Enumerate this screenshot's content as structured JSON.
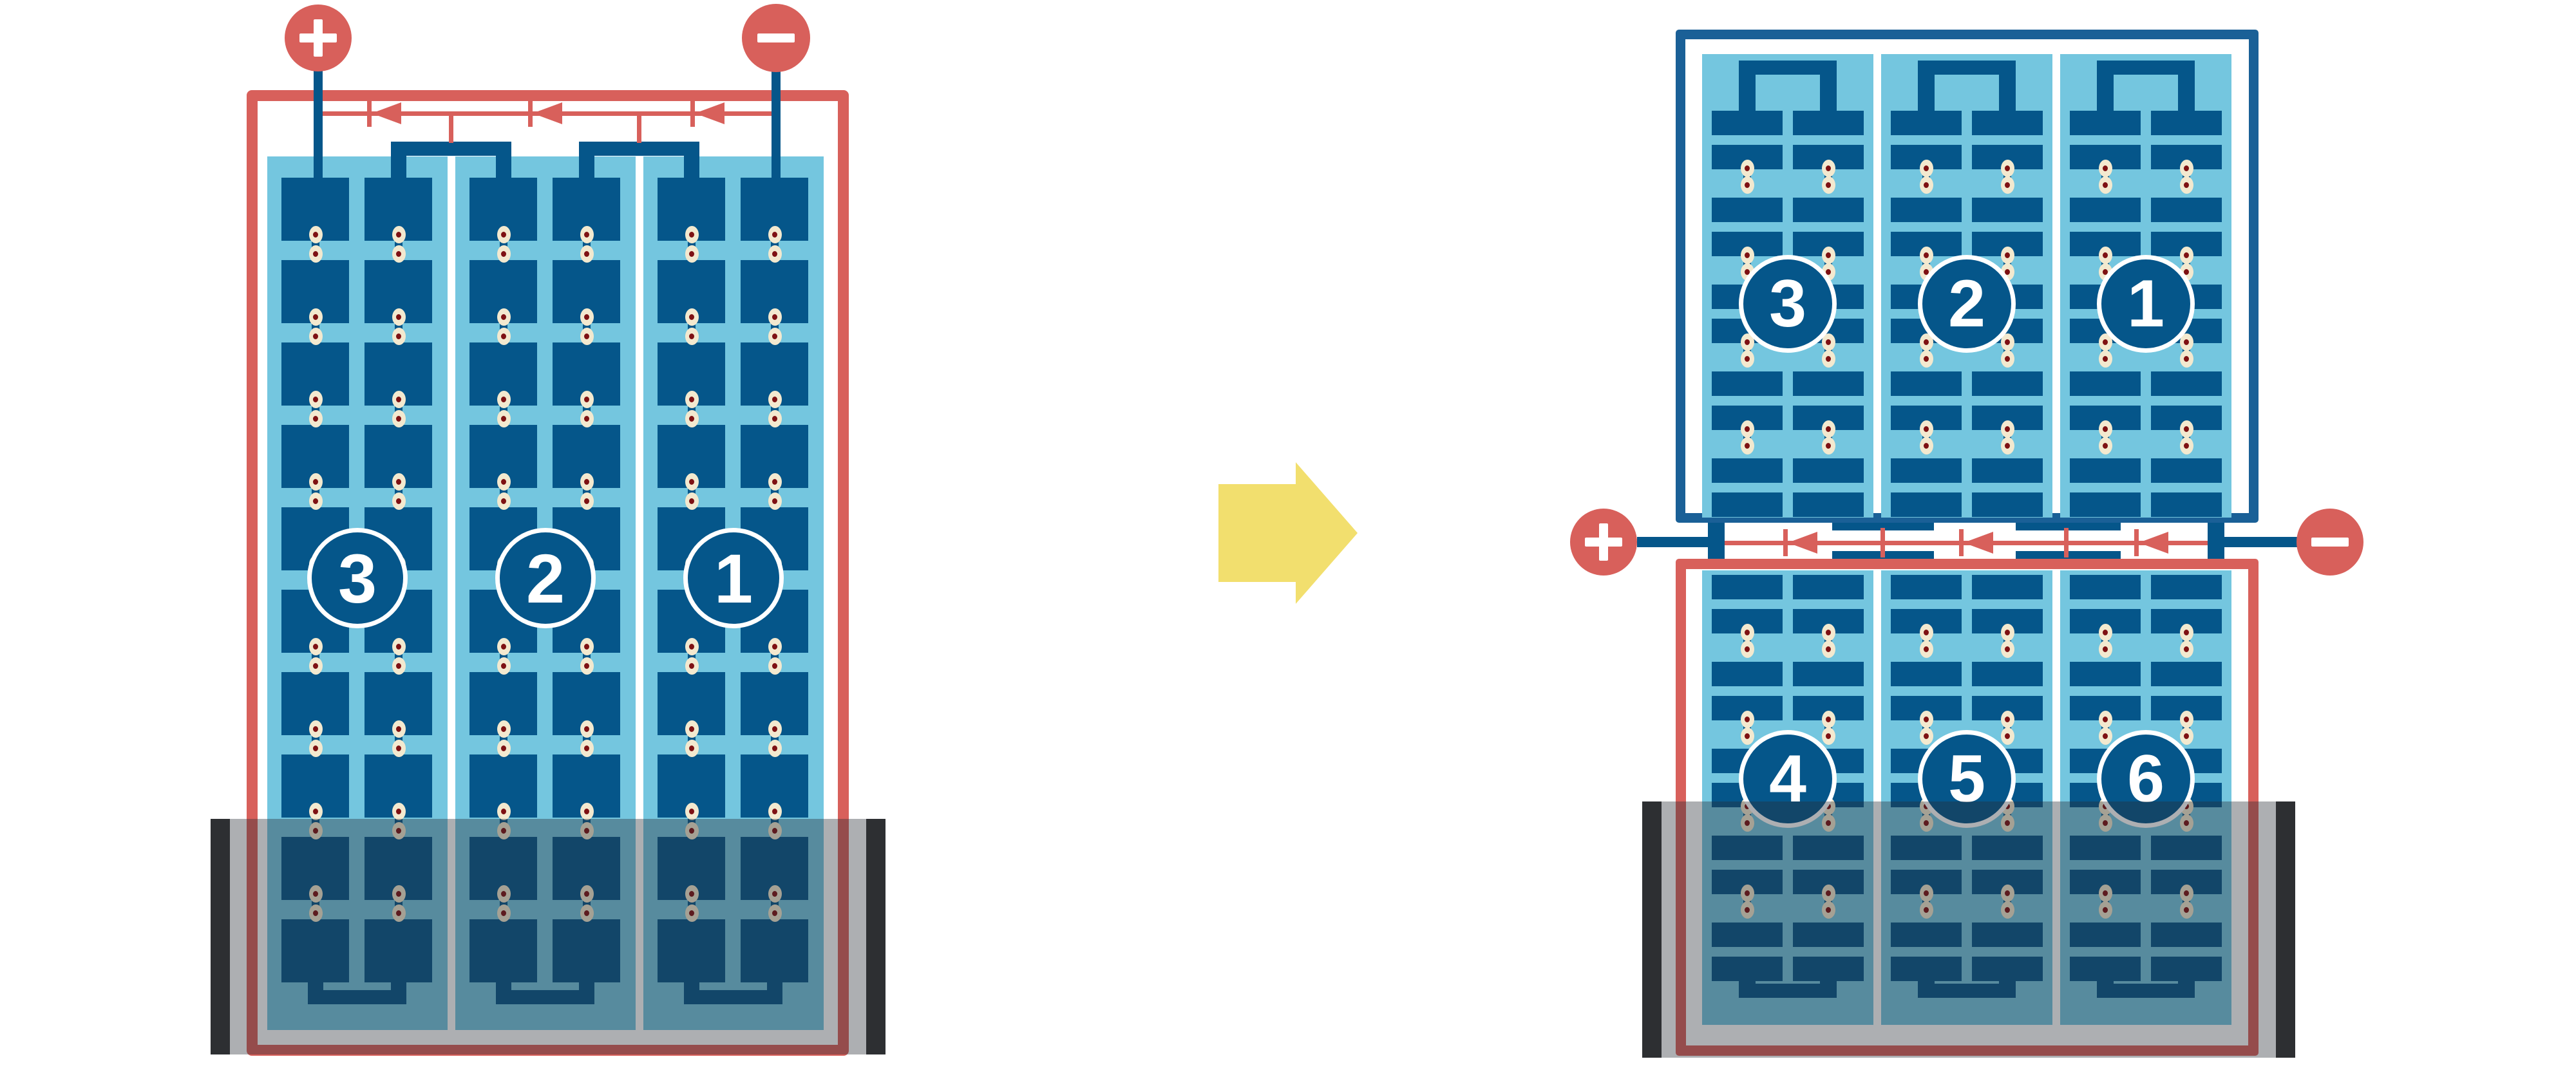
{
  "palette": {
    "red": "#D8605B",
    "frame_blue": "#1A6097",
    "cell_blue": "#05568A",
    "light_blue": "#74C6DF",
    "cream": "#F3E9CF",
    "dot_red": "#7E1113",
    "arrow_yellow": "#F2DF6E",
    "shade": "rgba(40,46,52,0.38)",
    "shade_bar": "rgba(22,25,27,0.85)"
  },
  "left_module": {
    "terminals": [
      {
        "polarity": "positive",
        "icon": "plus-icon",
        "sign": "+"
      },
      {
        "polarity": "negative",
        "icon": "minus-icon",
        "sign": "−"
      }
    ],
    "strings": [
      {
        "number": "3"
      },
      {
        "number": "2"
      },
      {
        "number": "1"
      }
    ],
    "bypass_diode_count": 3,
    "rows_per_string": 10,
    "substrings_per_string": 2,
    "shaded_bottom": true
  },
  "transition": {
    "icon": "arrow-right-icon",
    "direction": "right"
  },
  "right_module": {
    "terminals": [
      {
        "polarity": "positive",
        "icon": "plus-icon",
        "sign": "+"
      },
      {
        "polarity": "negative",
        "icon": "minus-icon",
        "sign": "−"
      }
    ],
    "top_half": {
      "strings": [
        {
          "number": "3"
        },
        {
          "number": "2"
        },
        {
          "number": "1"
        }
      ],
      "rows_per_string": 10
    },
    "bottom_half": {
      "strings": [
        {
          "number": "4"
        },
        {
          "number": "5"
        },
        {
          "number": "6"
        }
      ],
      "rows_per_string": 10
    },
    "bypass_diode_count": 3,
    "shaded_bottom": true
  }
}
